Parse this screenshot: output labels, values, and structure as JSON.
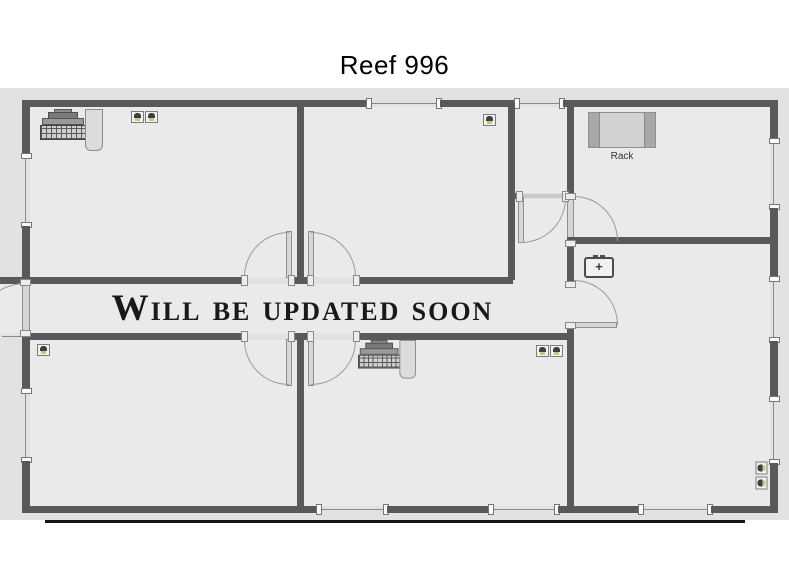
{
  "page": {
    "title": "Reef 996"
  },
  "floorplan": {
    "watermark": "Will be updated soon",
    "labels": {
      "rack": "Rack",
      "first_aid_plus": "+"
    },
    "colors": {
      "wall": "#595959",
      "canvas": "#e2e2e2",
      "room_fill": "#eaeaea",
      "door_leaf": "#d6d6d6",
      "window_line": "#8a8a8a",
      "watermark_text": "#191919",
      "underline": "#141414",
      "title_text": "#000000"
    },
    "icons": [
      "pc-workstation-icon",
      "rj45-jack-icon",
      "first-aid-box-icon",
      "rack-table",
      "door-leaf",
      "door-swing-arc",
      "window-marker"
    ]
  }
}
